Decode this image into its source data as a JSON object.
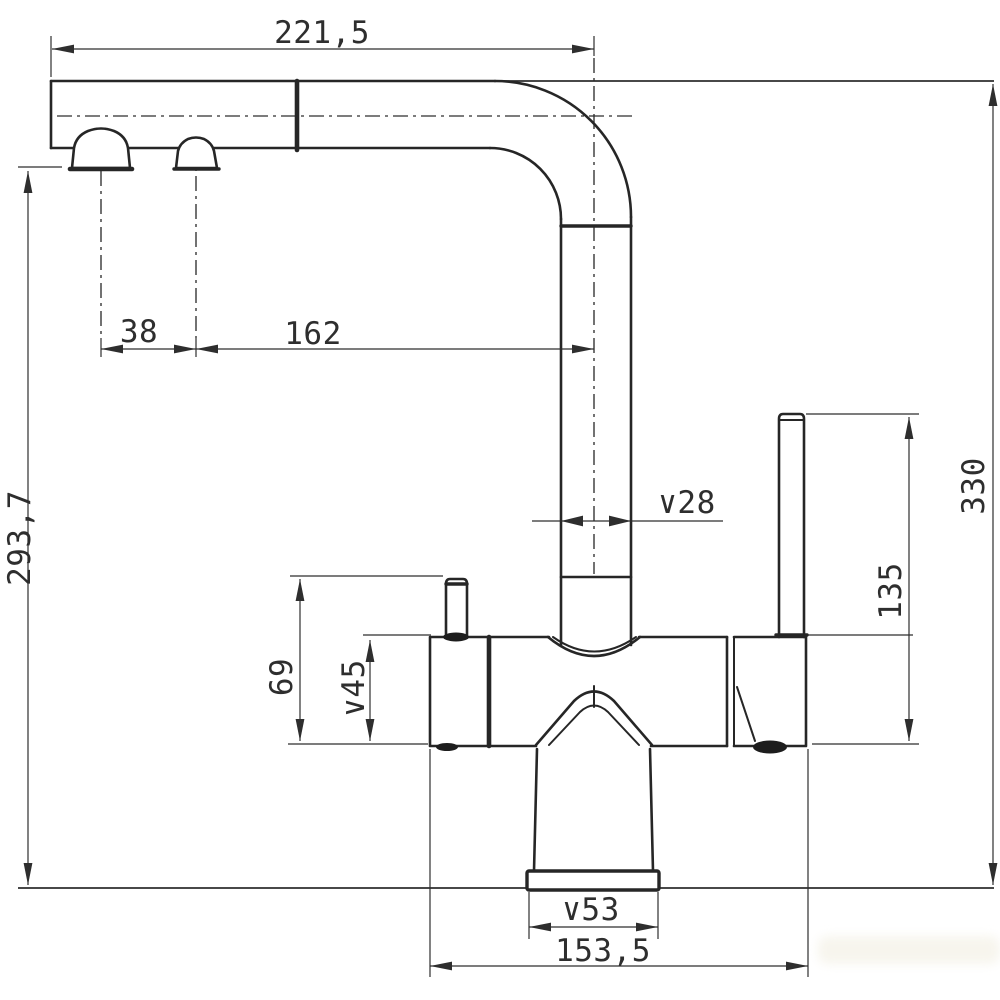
{
  "drawing": {
    "title": "Kitchen mixer faucet dimensional drawing",
    "view": "side elevation",
    "units": "mm",
    "colors": {
      "line": "#262626",
      "dimension": "#2e2e2e",
      "background": "#ffffff",
      "watermark": "#f3f0e4"
    },
    "dims": {
      "spout_reach": "221,5",
      "outlet_spacing": "38",
      "outlet_to_axis": "162",
      "spout_outlet_height": "293,7",
      "spout_tube_diameter": "∨28",
      "overall_height": "330",
      "lever_height": "135",
      "body_height": "69",
      "body_diameter": "∨45",
      "base_diameter": "∨53",
      "overall_depth": "153,5"
    }
  }
}
